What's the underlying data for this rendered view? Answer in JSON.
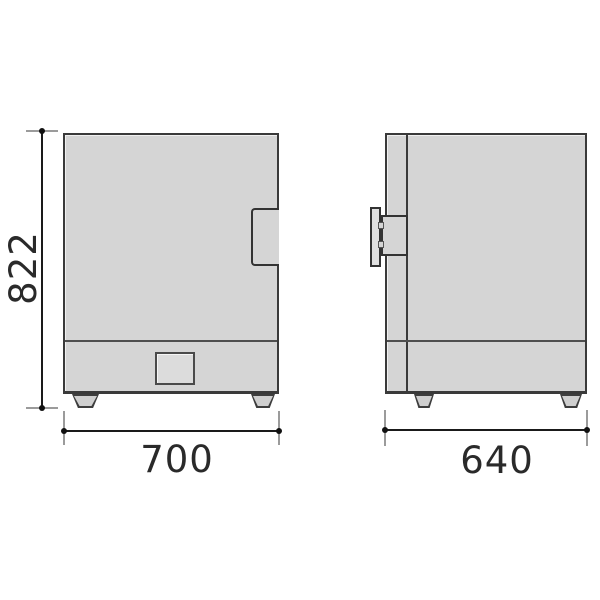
{
  "page": {
    "background": "#ffffff"
  },
  "diagram": {
    "kind": "dimensional-drawing",
    "labels": {
      "height": "822",
      "width": "700",
      "depth": "640"
    },
    "colors": {
      "body_fill": "#d5d5d5",
      "body_outline": "#3a3a3a",
      "dimension_line": "#1a1a1a",
      "extension_line": "#9b9b9b",
      "label_text": "#2a2a2a"
    }
  }
}
